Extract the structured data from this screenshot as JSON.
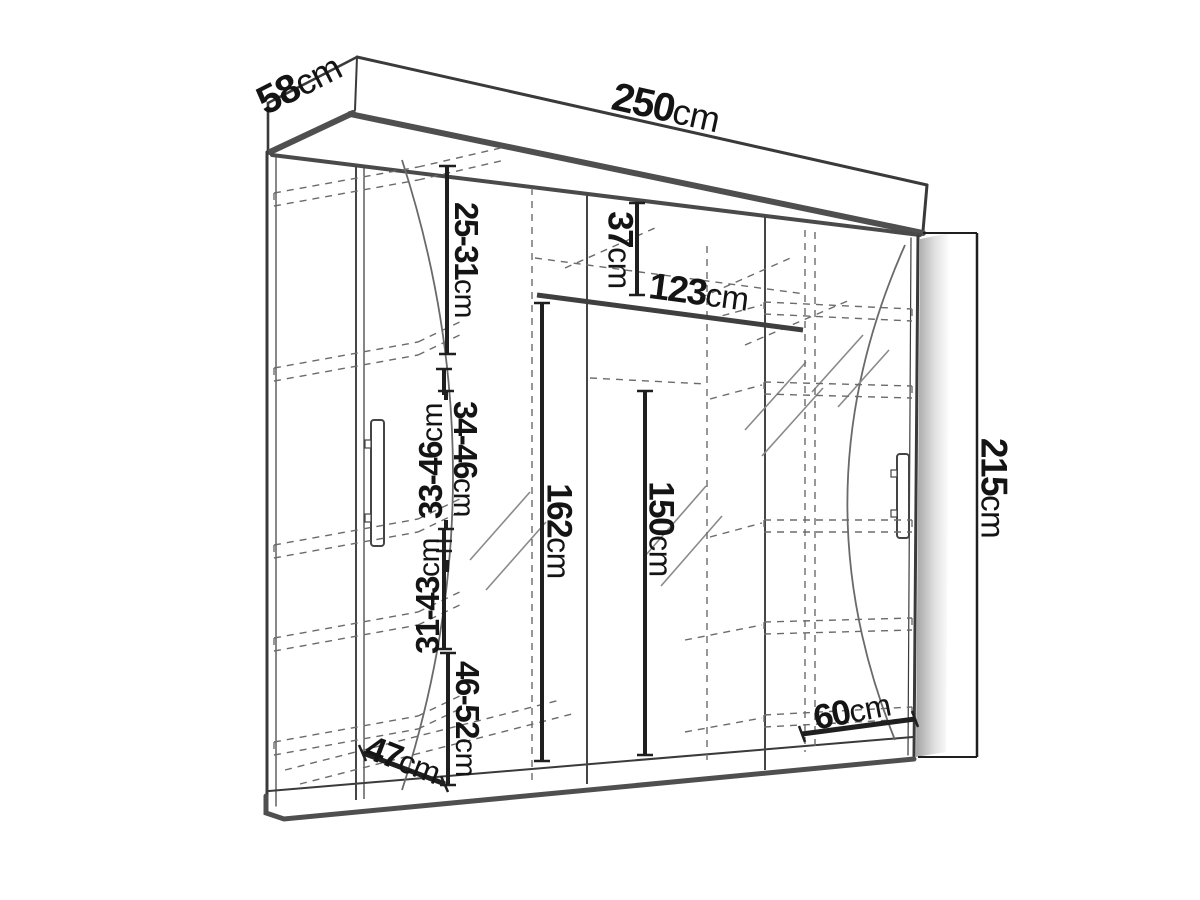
{
  "diagram": {
    "type": "wardrobe-dimension-drawing",
    "background_color": "#ffffff",
    "line_color": "#3a3a3a",
    "text_color": "#141414"
  },
  "dims": {
    "depth": {
      "value": "58",
      "unit": "cm"
    },
    "width": {
      "value": "250",
      "unit": "cm"
    },
    "height": {
      "value": "215",
      "unit": "cm"
    },
    "top_shelf_gap": {
      "value": "25-31",
      "unit": "cm"
    },
    "shelf_gap_a": {
      "value": "33-46",
      "unit": "cm"
    },
    "shelf_gap_b": {
      "value": "34-46",
      "unit": "cm"
    },
    "shelf_gap_c": {
      "value": "31-43",
      "unit": "cm"
    },
    "shelf_gap_d": {
      "value": "46-52",
      "unit": "cm"
    },
    "top_section": {
      "value": "37",
      "unit": "cm"
    },
    "rail_width": {
      "value": "123",
      "unit": "cm"
    },
    "left_interior": {
      "value": "162",
      "unit": "cm"
    },
    "mid_interior": {
      "value": "150",
      "unit": "cm"
    },
    "bottom_depth": {
      "value": "47",
      "unit": "cm"
    },
    "shelf_width": {
      "value": "60",
      "unit": "cm"
    }
  }
}
